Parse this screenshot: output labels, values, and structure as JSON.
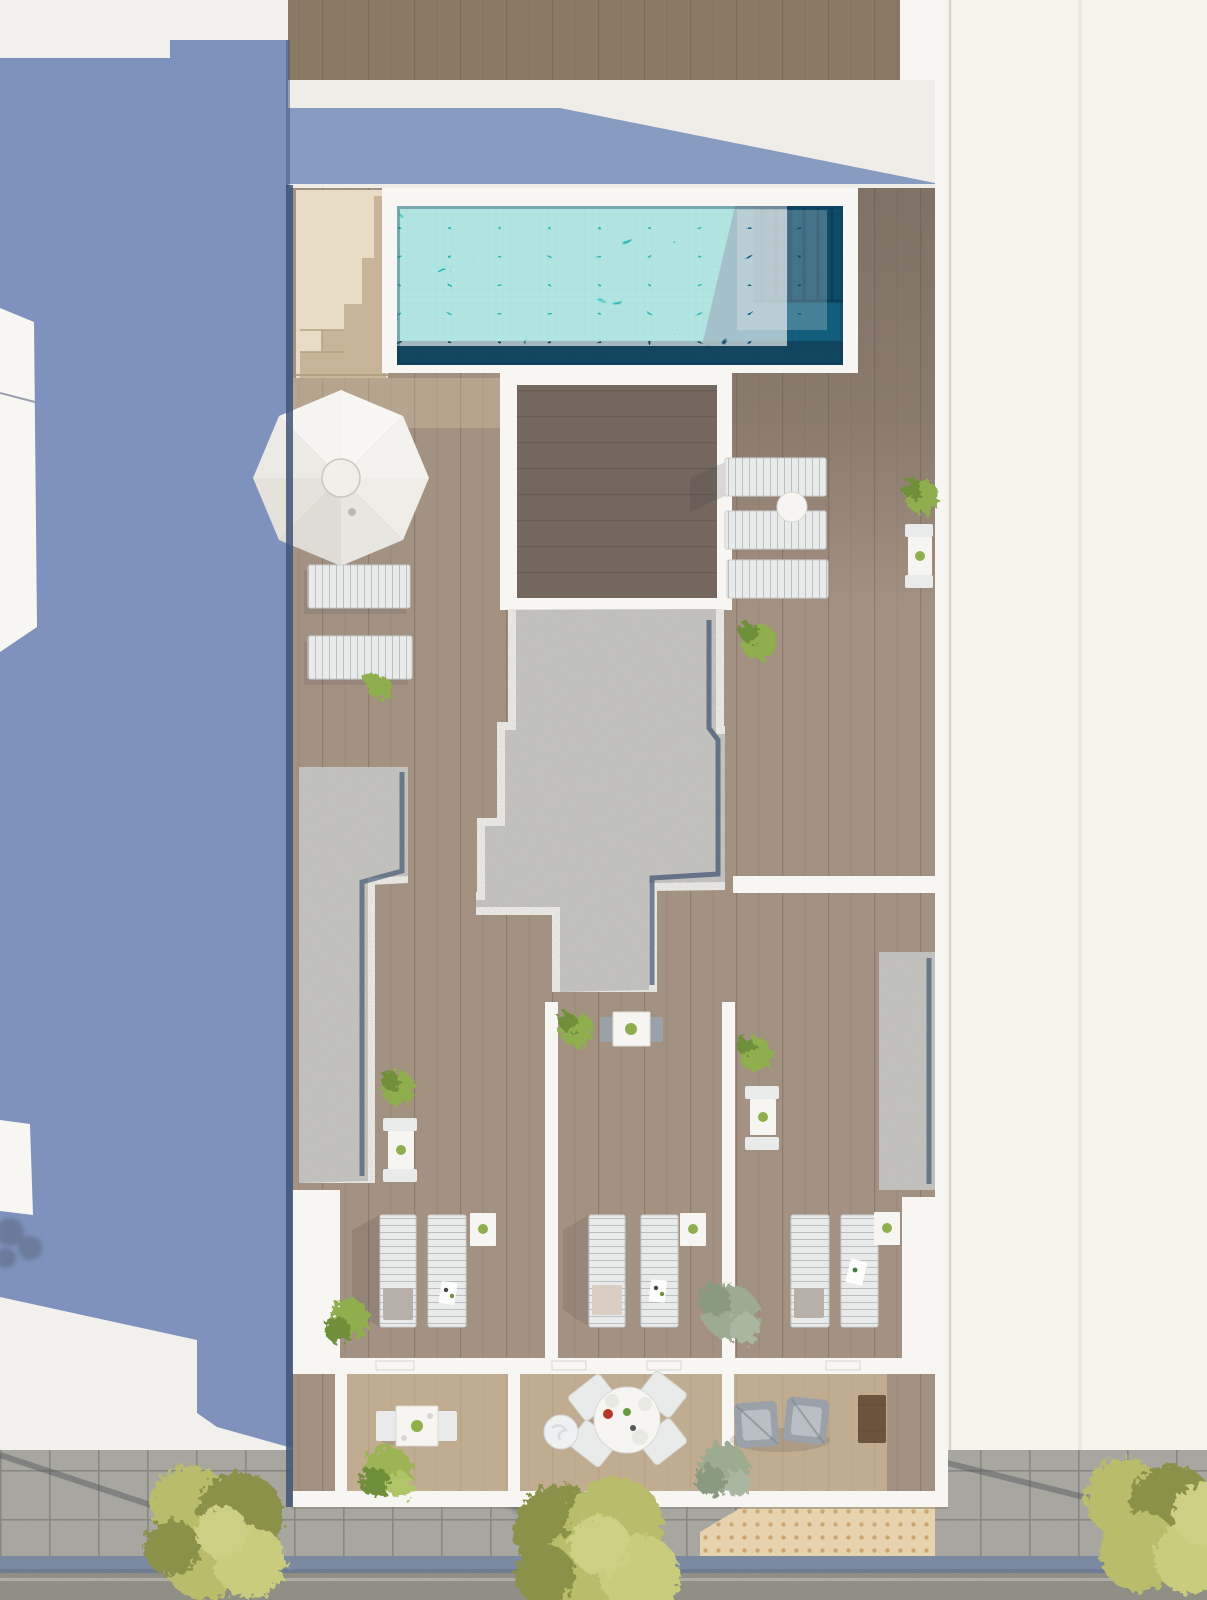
{
  "scene": {
    "type": "architectural-aerial-render",
    "description": "top-down 3D render of a building rooftop terrace with pool, between two neighboring buildings, street at bottom",
    "objects": [
      "swimming-pool",
      "pool-deep-end",
      "pool-steps-bench",
      "roof-staircase",
      "parasol-umbrella",
      "sun-lounger",
      "lounger-side-table",
      "round-dining-table",
      "square-dining-table",
      "armchair",
      "gravel-roof",
      "gravel-strip",
      "wood-deck",
      "terrace-room",
      "balcony",
      "potted-bush",
      "street-tree",
      "sidewalk",
      "tactile-paving",
      "gutter",
      "road",
      "building-shadow"
    ],
    "counts": {
      "sun_loungers": 11,
      "terrace_rooms": 3,
      "balconies": 3,
      "street_trees": 3,
      "roof_bushes": 10
    }
  },
  "colors": {
    "bg_white": "#f2f0ec",
    "neighbor_right": "#f7f4eb",
    "shadow_blue": "#7e92bd",
    "building_wall": "#efede7",
    "wall_bright": "#f7f6f2",
    "top_wood": "#8a7a65",
    "deck_base": "#a39181",
    "deck_dark": "#4f463f",
    "deck_light": "#e6cfae",
    "inset_wood": "#74675d",
    "balcony_wood": "#d9c29e",
    "gravel": "#c8c7c3",
    "roof_edge_navy": "#31486b",
    "pool_shallow": "#2fbcb8",
    "pool_deep": "#135e7d",
    "pool_deepest": "#0f4c6a",
    "pool_bottom": "#12455f",
    "lounger_white": "#e9ebea",
    "chair_gray": "#9aa1a8",
    "table_white": "#f6f5f2",
    "plant_green": "#8fae4e",
    "plant_green_dark": "#6f8f3a",
    "plant_sage": "#9dab90",
    "street_tree": "#b9bc6a",
    "street_tree_dark": "#8b9148",
    "pavement": "#a8a7a1",
    "tactile": "#e6d2ad",
    "gutter": "#7b89a1",
    "asphalt": "#8d8d83",
    "curb": "#b5b4aa",
    "shadow_soft": "#3c3f46",
    "west_edge": "#3f5377",
    "side_table_wood": "#6b543e",
    "towel_gray": "#b6b0a9",
    "towel_beige": "#d8cfc2",
    "plate_red": "#b5372a",
    "plate_green": "#679a41"
  }
}
